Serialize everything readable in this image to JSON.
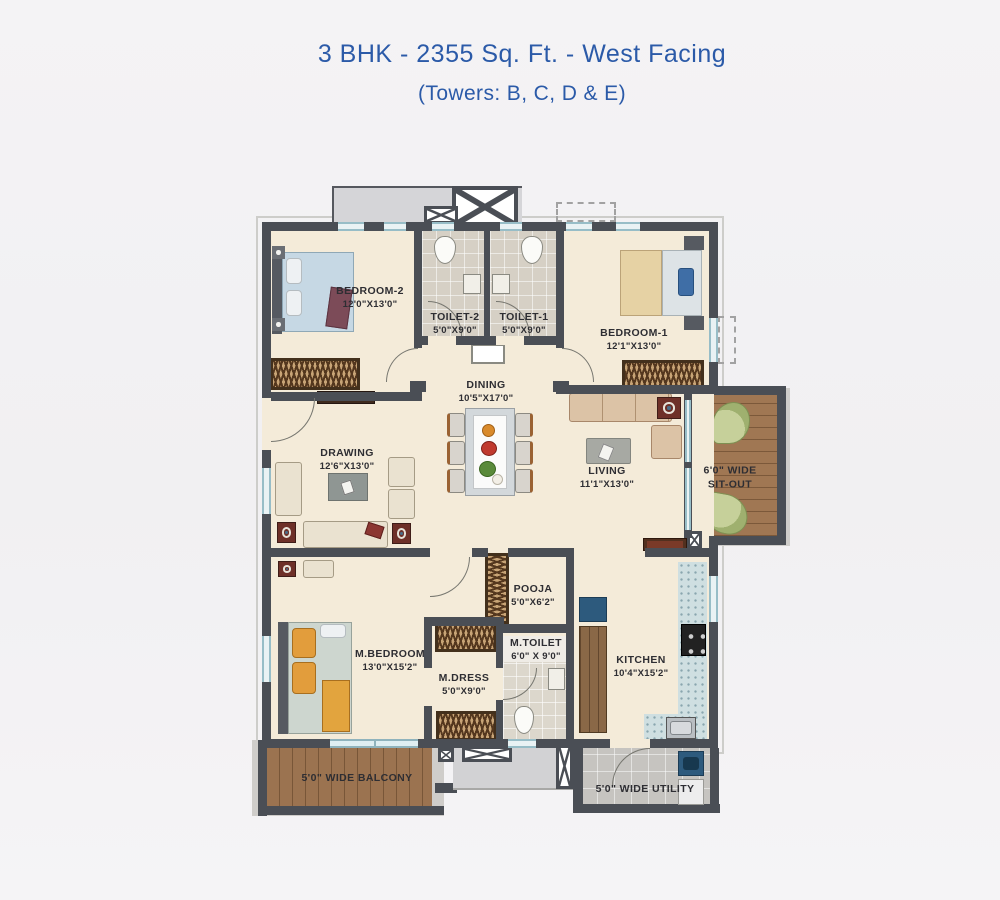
{
  "title": {
    "line1": "3 BHK - 2355 Sq. Ft. - West Facing",
    "line2": "(Towers: B, C, D & E)"
  },
  "rooms": {
    "bedroom2": {
      "name": "BEDROOM-2",
      "dims": "12'0\"X13'0\""
    },
    "toilet2": {
      "name": "TOILET-2",
      "dims": "5'0\"X9'0\""
    },
    "toilet1": {
      "name": "TOILET-1",
      "dims": "5'0\"X9'0\""
    },
    "bedroom1": {
      "name": "BEDROOM-1",
      "dims": "12'1\"X13'0\""
    },
    "dining": {
      "name": "DINING",
      "dims": "10'5\"X17'0\""
    },
    "drawing": {
      "name": "DRAWING",
      "dims": "12'6\"X13'0\""
    },
    "living": {
      "name": "LIVING",
      "dims": "11'1\"X13'0\""
    },
    "sitout": {
      "line1": "6'0\" WIDE",
      "line2": "SIT-OUT"
    },
    "pooja": {
      "name": "POOJA",
      "dims": "5'0\"X6'2\""
    },
    "mbedroom": {
      "name": "M.BEDROOM",
      "dims": "13'0\"X15'2\""
    },
    "mdress": {
      "name": "M.DRESS",
      "dims": "5'0\"X9'0\""
    },
    "mtoilet": {
      "name": "M.TOILET",
      "dims": "6'0\" X 9'0\""
    },
    "kitchen": {
      "name": "KITCHEN",
      "dims": "10'4\"X15'2\""
    },
    "balcony": {
      "name": "5'0\" WIDE BALCONY"
    },
    "utility": {
      "name": "5'0\" WIDE UTILITY"
    }
  },
  "colors": {
    "accent_blue": "#2b5aa8",
    "wall": "#4a4e55",
    "floor_cream": "#f4ebd9",
    "wood": "#9b7350",
    "label_text": "#2e2e33"
  }
}
